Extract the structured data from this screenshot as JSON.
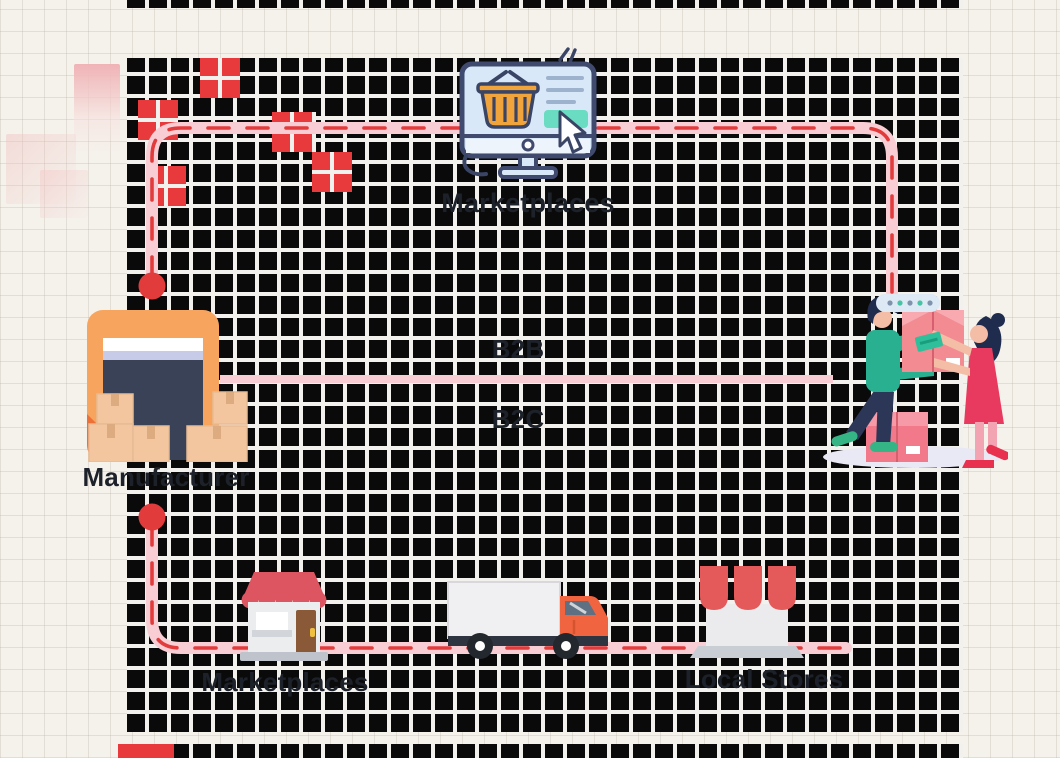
{
  "canvas": {
    "width": 1060,
    "height": 758
  },
  "labels": {
    "online_marketplaces": "Marketplaces",
    "manufacturer": "Manufacturer",
    "b2b": "B2B",
    "b2c": "B2C",
    "retail_marketplaces": "Marketplaces",
    "local_stores": "Local Stores"
  },
  "icons": {
    "online_marketplaces": "online-shopping-monitor-icon",
    "manufacturer": "warehouse-boxes-icon",
    "retail_marketplaces": "storefront-icon",
    "transport": "delivery-truck-icon",
    "local_stores": "market-stall-icon",
    "customers": "buyer-seller-exchange-illustration"
  },
  "routes": {
    "top": "manufacturer → online marketplaces → customers (dashed)",
    "middle": "manufacturer → customers (direct line between B2B and B2C)",
    "bottom": "manufacturer → retail marketplaces → truck → local stores (dashed)"
  },
  "colors": {
    "page_bg": "#f5f2ec",
    "checker_dark": "#0a0a0a",
    "grid_line": "#f2f1ee",
    "route_pink": "#f9cdd4",
    "route_dash_red": "#e23b3b",
    "node_dot_red": "#e23b3b",
    "accent_red_squares": "#e8393d",
    "warehouse_orange": "#f7a55e",
    "navy": "#3a4257",
    "teal": "#69dcc1",
    "label_text": "#1d212a"
  }
}
